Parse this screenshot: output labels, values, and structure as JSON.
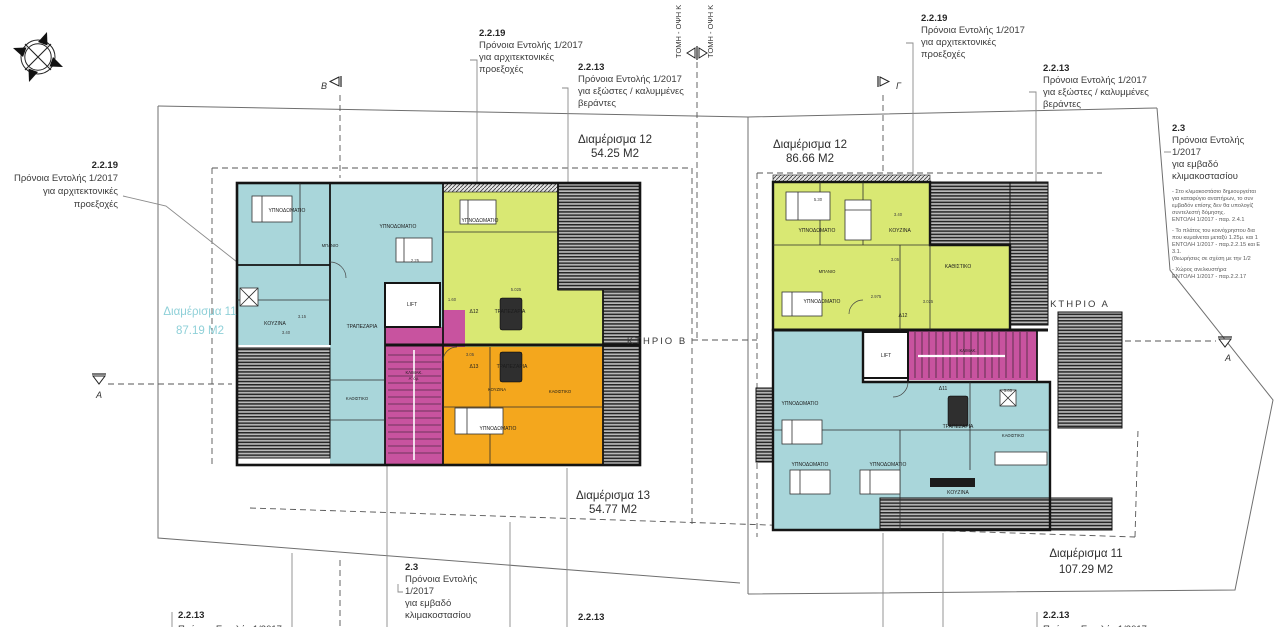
{
  "colors": {
    "cyan": "#a9d6da",
    "green": "#d9e873",
    "orange": "#f4a71d",
    "magenta": "#c8539f",
    "cyan_label": "#8fd0d8",
    "hatch_bg": "#b9b9b9",
    "hatch_line": "#262626",
    "wall": "#141414"
  },
  "sections": {
    "b": "Β",
    "g": "Γ",
    "a_left": "Α",
    "a_right": "Α",
    "tomi_left": "ΤΟΜΗ - ΟΨΗ Κ",
    "tomi_right": "ΤΟΜΗ - ΟΨΗ Κ"
  },
  "buildings": {
    "b": "ΚΤΗΡΙΟ Β",
    "a": "ΚΤΗΡΙΟ Α"
  },
  "apartments": {
    "b12": {
      "name": "Διαμέρισμα 12",
      "area": "54.25 M2"
    },
    "a12": {
      "name": "Διαμέρισμα 12",
      "area": "86.66 M2"
    },
    "b11": {
      "name": "Διαμέρισμα 11",
      "area": "87.19 M2"
    },
    "b13": {
      "name": "Διαμέρισμα 13",
      "area": "54.77 M2"
    },
    "a11": {
      "name": "Διαμέρισμα 11",
      "area": "107.29 M2"
    }
  },
  "ann": {
    "left2219": {
      "ref": "2.2.19",
      "lines": [
        "Πρόνοια Εντολής 1/2017",
        "για αρχιτεκτονικές",
        "προεξοχές"
      ]
    },
    "b2219": {
      "ref": "2.2.19",
      "lines": [
        "Πρόνοια Εντολής 1/2017",
        "για αρχιτεκτονικές",
        "προεξοχές"
      ]
    },
    "b2213": {
      "ref": "2.2.13",
      "lines": [
        "Πρόνοια Εντολής 1/2017",
        "για εξώστες / καλυμμένες",
        "βεράντες"
      ]
    },
    "a2219": {
      "ref": "2.2.19",
      "lines": [
        "Πρόνοια Εντολής 1/2017",
        "για αρχιτεκτονικές",
        "προεξοχές"
      ]
    },
    "a2213": {
      "ref": "2.2.13",
      "lines": [
        "Πρόνοια Εντολής 1/2017",
        "για εξώστες / καλυμμένες",
        "βεράντες"
      ]
    },
    "right23": {
      "ref": "2.3",
      "lines": [
        "Πρόνοια Εντολής",
        "1/2017",
        "για εμβαδό",
        "κλιμακοστασίου"
      ],
      "notes": [
        "- Στο κλιμακοστάσιο δημιουργείται",
        "για καταφύγιο αναπήρων, το συν",
        "εμβαδόν επίσης δεν θα υπολογίζ",
        "συντελεστή δόμησης.",
        "ΕΝΤΟΛΗ 1/2017 - παρ. 2.4.1",
        "- Το πλάτος του κοινόχρηστου δια",
        "που κυμαίνεται μεταξύ 1.25μ. και 1",
        "ΕΝΤΟΛΗ 1/2017 - παρ.2.2.15 και Ε",
        "3.1.",
        "(θεωρήσεις σε σχέση με την 1/2",
        "- Χώρος ανελκυστήρα",
        "ΕΝΤΟΛΗ 1/2017 - παρ.2.2.17"
      ]
    },
    "bottom23": {
      "ref": "2.3",
      "lines": [
        "Πρόνοια Εντολής",
        "1/2017",
        "για εμβαδό",
        "κλιμακοστασίου"
      ]
    },
    "bl2213": {
      "ref": "2.2.13",
      "line": "Πρόνοια Εντολής 1/2017"
    },
    "bm2213": {
      "ref": "2.2.13",
      "line": "Πρόνοια Εντολής 1/2017"
    },
    "br2213": {
      "ref": "2.2.13",
      "line": "Πρόνοια Εντολής 1/2017"
    }
  },
  "rooms_b": [
    "ΥΠΝΟΔΩΜΑΤΙΟ",
    "ΥΠΝΟΔΩΜΑΤΙΟ",
    "ΜΠΑΝΙΟ",
    "ΚΟΥΖΙΝΑ",
    "ΤΡΑΠΕΖΑΡΙΑ",
    "ΚΑΘΙΣΤΙΚΟ",
    "Δ12",
    "ΤΡΑΠΕΖΑΡΙΑ",
    "ΥΠΝΟΔΩΜΑΤΙΟ",
    "Δ13",
    "ΤΡΑΠΕΖΑΡΙΑ",
    "ΚΟΥΖΙΝΑ",
    "ΚΑΘΙΣΤΙΚΟ",
    "ΥΠΝΟΔΩΜΑΤΙΟ",
    "LIFT",
    "ΚΛΙΜΑΚ.",
    "Α' όρ."
  ],
  "rooms_a": [
    "ΥΠΝΟΔΩΜΑΤΙΟ",
    "ΚΟΥΖΙΝΑ",
    "ΜΠΑΝΙΟ",
    "ΚΑΘΙΣΤΙΚΟ",
    "ΥΠΝΟΔΩΜΑΤΙΟ",
    "Δ12",
    "LIFT",
    "ΚΛΙΜΑΚ.",
    "Δ11",
    "ΤΡΑΠΕΖΑΡΙΑ",
    "ΚΑΘΙΣΤΙΚΟ",
    "ΥΠΝΟΔΩΜΑΤΙΟ",
    "ΥΠΝΟΔΩΜΑΤΙΟ",
    "ΥΠΝΟΔΩΜΑΤΙΟ",
    "ΚΟΥΖΙΝΑ"
  ],
  "dims": [
    "3.15",
    "3.40",
    "5.025",
    "1.60",
    "3.05",
    "2.25",
    "5.30",
    "3.40",
    "3.05",
    "2.975",
    "3.025",
    "5.05"
  ]
}
